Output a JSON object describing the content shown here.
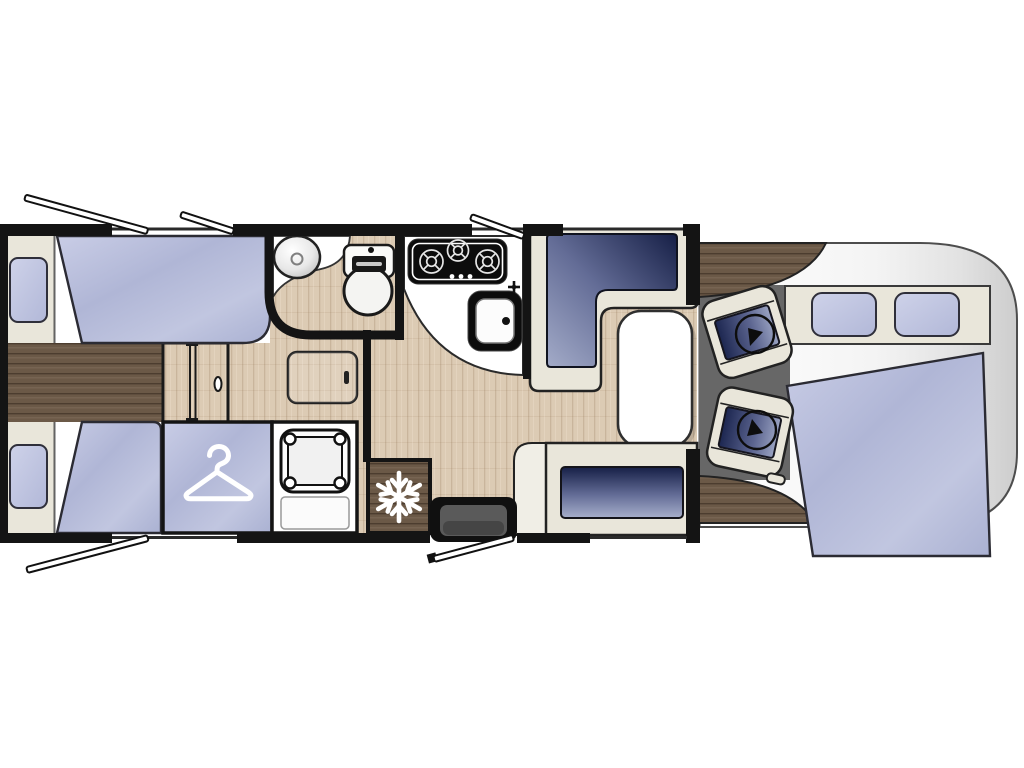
{
  "colors": {
    "wall": "#141414",
    "cream": "#e9e6da",
    "white": "#ffffff",
    "wood_light": "#dccbb4",
    "wood_dark": "#6b5947",
    "mattress": "#b8bedb",
    "cushion_dark": "#18224a",
    "cushion_light": "#a3abc8",
    "cab_floor": "#676767",
    "vehicle_body": "#e6e6e6",
    "outline": "#222222"
  },
  "icons": {
    "wardrobe": "hanger-icon",
    "fridge": "snowflake-icon",
    "seat_rotation": "swivel-arrow-icon",
    "open_window": "window-stay-bar",
    "entry_door": "door-swing-bar"
  },
  "regions": {
    "floor_plan": "Motorhome floor plan, top view",
    "rear_bedroom": "Rear bedroom with twin single beds",
    "bed_top": "Single bed (offside)",
    "bed_bottom": "Single bed (nearside)",
    "pillow": "Pillow",
    "wardrobe": "Wardrobe",
    "shower": "Shower cubicle",
    "bathroom": "Washroom with basin and toilet",
    "kitchen": "Kitchen with 3-burner hob and sink",
    "fridge": "Refrigerator",
    "dinette": "L-shaped lounge with table and travel bench",
    "table": "Dinette table",
    "entrance": "Entrance door with step",
    "cab": "Driver cab with two swivel seats",
    "front_bed": "Drop-down double bed over cab",
    "window": "Open window",
    "door_panel": "Interior sliding door"
  }
}
